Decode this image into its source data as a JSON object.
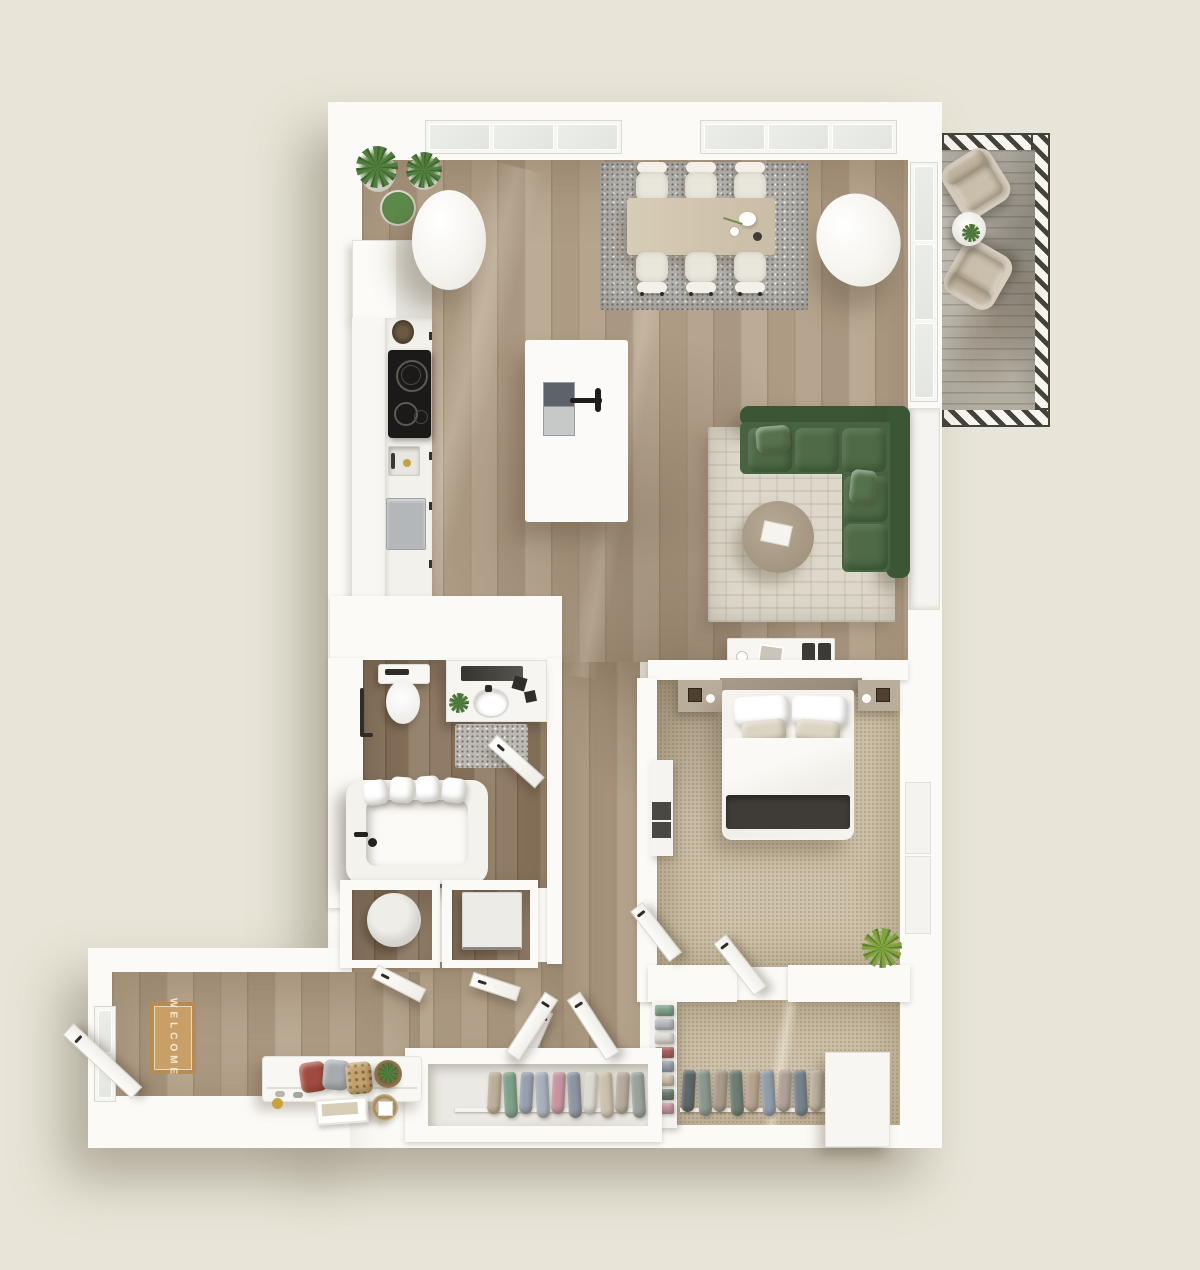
{
  "scene": {
    "title": "apartment-floor-plan-3d-top-view",
    "mat_text": "WELCOME",
    "colors": {
      "background": "#e8e5d8",
      "walls": "#fbfaf7",
      "wood_floor": "#b3a28c",
      "bathroom_wood_floor": "#8d7a64",
      "bedroom_carpet": "#cfc2aa",
      "balcony_deck": "#b2ada1",
      "sofa_green": "#47633f",
      "welcome_mat_tan": "#c79f67",
      "dining_rug_gray": "#b3b1ac",
      "living_rug_cream": "#ddd8ca",
      "table_wood": "#d2c7b1",
      "blanket_charcoal": "#3f3c38",
      "cooktop_black": "#1b1a18"
    },
    "rooms": [
      {
        "name": "kitchen",
        "furniture": [
          "fridge",
          "tall-cabinets",
          "counter",
          "cooktop",
          "kitchen-sink",
          "dishwasher",
          "island-with-sink",
          "potted-plants",
          "round-column"
        ]
      },
      {
        "name": "dining-area",
        "furniture": [
          "dining-table",
          "six-chairs",
          "gray-speckled-rug",
          "round-column",
          "table-decor"
        ]
      },
      {
        "name": "living-room",
        "furniture": [
          "green-sectional-sofa",
          "round-coffee-table",
          "cream-patterned-rug",
          "media-console",
          "speakers"
        ]
      },
      {
        "name": "balcony",
        "furniture": [
          "lounge-chair",
          "lounge-chair",
          "round-side-table",
          "hatched-railing"
        ]
      },
      {
        "name": "bathroom",
        "furniture": [
          "toilet",
          "vanity-with-mirror",
          "sink",
          "bath-mat",
          "bathtub",
          "towels",
          "towel-rail",
          "door"
        ]
      },
      {
        "name": "laundry-closets",
        "furniture": [
          "washing-machine",
          "utility-unit",
          "closet-doors"
        ]
      },
      {
        "name": "bedroom",
        "furniture": [
          "double-bed",
          "headboard",
          "nightstand",
          "nightstand",
          "dresser",
          "plant",
          "doors"
        ]
      },
      {
        "name": "walk-in-closet",
        "furniture": [
          "hanging-clothes-rail",
          "folded-clothes-shelf",
          "white-cabinet"
        ]
      },
      {
        "name": "hall-closet",
        "furniture": [
          "hanging-clothes-rail",
          "double-v-doors"
        ]
      },
      {
        "name": "entry-hall",
        "furniture": [
          "entry-door",
          "welcome-mat",
          "bench",
          "pillows",
          "wall-art",
          "baskets",
          "side-window"
        ]
      }
    ],
    "hall_closet_clothes_colors": [
      "#bdaf97",
      "#7ea189",
      "#97a1ae",
      "#a9b0bb",
      "#c795a1",
      "#8e96a2",
      "#dcd9d2",
      "#cdc1ac",
      "#b4ab9c",
      "#9aa29e"
    ],
    "bedroom_closet_clothes_colors": [
      "#5e6769",
      "#8a978e",
      "#a79a88",
      "#6d7d72",
      "#b6a38e",
      "#909daa",
      "#b0a196",
      "#77838c",
      "#c2b7a7",
      "#636c6e",
      "#96a391",
      "#baafb1"
    ],
    "folded_clothes_colors": [
      "#7ea189",
      "#b6b9be",
      "#dcd9d2",
      "#a86060",
      "#97a1ae",
      "#cdc1ac",
      "#6f7b72",
      "#c795a1"
    ]
  }
}
